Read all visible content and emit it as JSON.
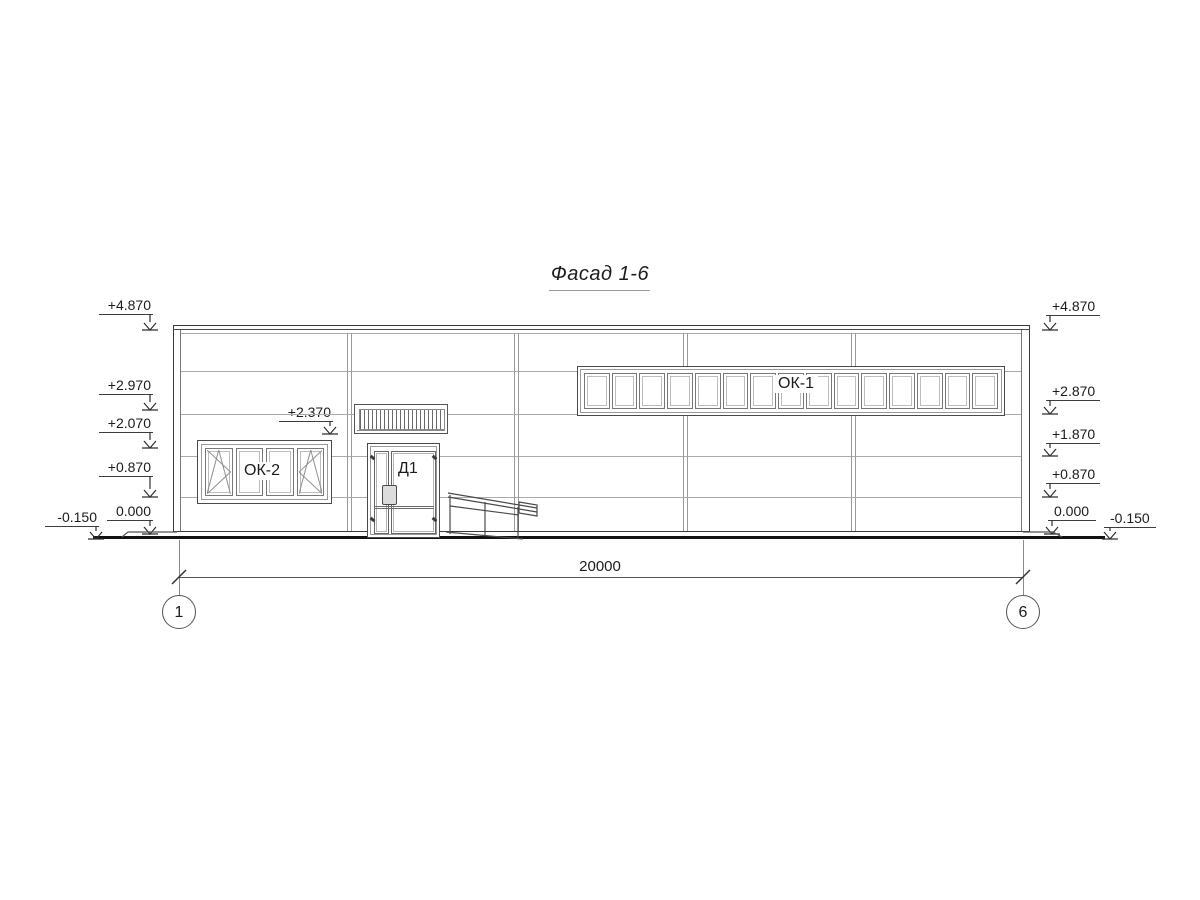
{
  "drawing": {
    "title": "Фасад 1-6",
    "dimension_total": "20000",
    "window_ok1": {
      "label": "ОК-1",
      "panes": 15
    },
    "window_ok2": {
      "label": "ОК-2",
      "panes": 4,
      "opening_pane_indexes": [
        0,
        3
      ]
    },
    "door": {
      "label": "Д1"
    },
    "grid_axes": [
      {
        "label": "1",
        "x": 179
      },
      {
        "label": "6",
        "x": 1023
      }
    ],
    "elevation_marks": [
      {
        "label": "+4.870",
        "side": "left",
        "shelf_x1": 99,
        "shelf_x2": 153,
        "shelf_y": 314,
        "arrow_x": 150,
        "tip_y": 329
      },
      {
        "label": "+2.970",
        "side": "left",
        "shelf_x1": 99,
        "shelf_x2": 153,
        "shelf_y": 394,
        "arrow_x": 150,
        "tip_y": 409
      },
      {
        "label": "+2.070",
        "side": "left",
        "shelf_x1": 99,
        "shelf_x2": 153,
        "shelf_y": 432,
        "arrow_x": 150,
        "tip_y": 447
      },
      {
        "label": "+0.870",
        "side": "left",
        "shelf_x1": 99,
        "shelf_x2": 153,
        "shelf_y": 476,
        "arrow_x": 150,
        "tip_y": 496
      },
      {
        "label": "0.000",
        "side": "left",
        "shelf_x1": 107,
        "shelf_x2": 153,
        "shelf_y": 520,
        "arrow_x": 150,
        "tip_y": 533
      },
      {
        "label": "-0.150",
        "side": "left",
        "shelf_x1": 45,
        "shelf_x2": 99,
        "shelf_y": 526,
        "arrow_x": 96,
        "tip_y": 538
      },
      {
        "label": "+2.370",
        "side": "left",
        "shelf_x1": 279,
        "shelf_x2": 333,
        "shelf_y": 421,
        "arrow_x": 330,
        "tip_y": 433
      },
      {
        "label": "+4.870",
        "side": "right",
        "shelf_x1": 1046,
        "shelf_x2": 1100,
        "shelf_y": 315,
        "arrow_x": 1050,
        "tip_y": 329
      },
      {
        "label": "+2.870",
        "side": "right",
        "shelf_x1": 1046,
        "shelf_x2": 1100,
        "shelf_y": 400,
        "arrow_x": 1050,
        "tip_y": 413
      },
      {
        "label": "+1.870",
        "side": "right",
        "shelf_x1": 1046,
        "shelf_x2": 1100,
        "shelf_y": 443,
        "arrow_x": 1050,
        "tip_y": 455
      },
      {
        "label": "+0.870",
        "side": "right",
        "shelf_x1": 1046,
        "shelf_x2": 1100,
        "shelf_y": 483,
        "arrow_x": 1050,
        "tip_y": 496
      },
      {
        "label": "0.000",
        "side": "right",
        "shelf_x1": 1048,
        "shelf_x2": 1096,
        "shelf_y": 520,
        "arrow_x": 1052,
        "tip_y": 533
      },
      {
        "label": "-0.150",
        "side": "right",
        "shelf_x1": 1104,
        "shelf_x2": 1156,
        "shelf_y": 527,
        "arrow_x": 1110,
        "tip_y": 538
      }
    ]
  },
  "colors": {
    "line_dark": "#3a3a3a",
    "line_mid": "#777777",
    "line_light": "#ababab",
    "ground": "#111111",
    "paper": "#ffffff"
  }
}
